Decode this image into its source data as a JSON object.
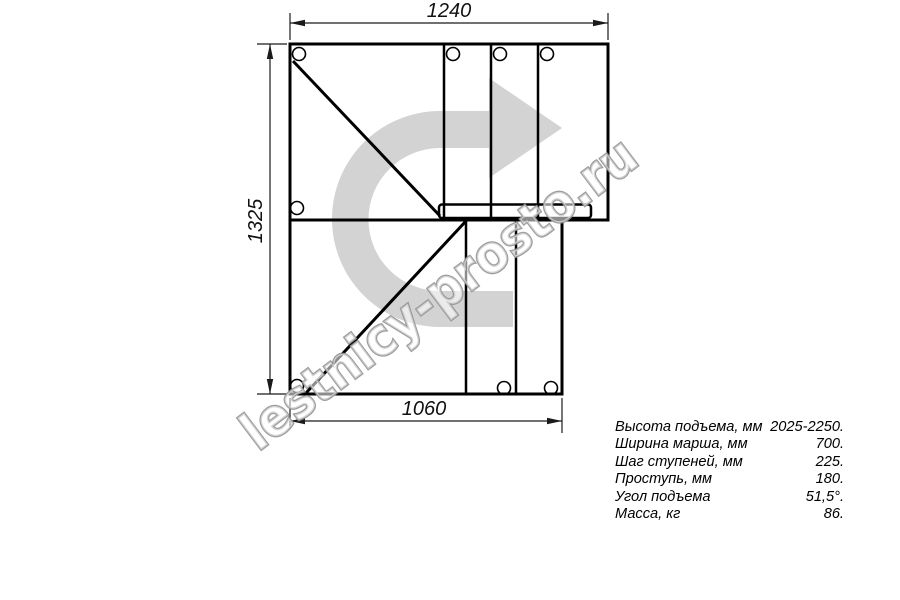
{
  "drawing": {
    "title": "Staircase plan (top view)",
    "dimensions": {
      "top": "1240",
      "left": "1325",
      "bottom": "1060"
    },
    "watermark": "lestnicy-prosto.ru",
    "colors": {
      "line": "#000000",
      "dimension": "#1a1a1a",
      "arrow_fill": "#d3d3d3",
      "watermark_outline": "#949494",
      "background": "#ffffff"
    }
  },
  "specs": {
    "rows": [
      {
        "label": "Высота подъема, мм",
        "value": "2025-2250."
      },
      {
        "label": "Ширина марша, мм",
        "value": "700."
      },
      {
        "label": "Шаг ступеней, мм",
        "value": "225."
      },
      {
        "label": "Проступь, мм",
        "value": "180."
      },
      {
        "label": "Угол подъема",
        "value": "51,5°."
      },
      {
        "label": "Масса, кг",
        "value": "86."
      }
    ]
  }
}
